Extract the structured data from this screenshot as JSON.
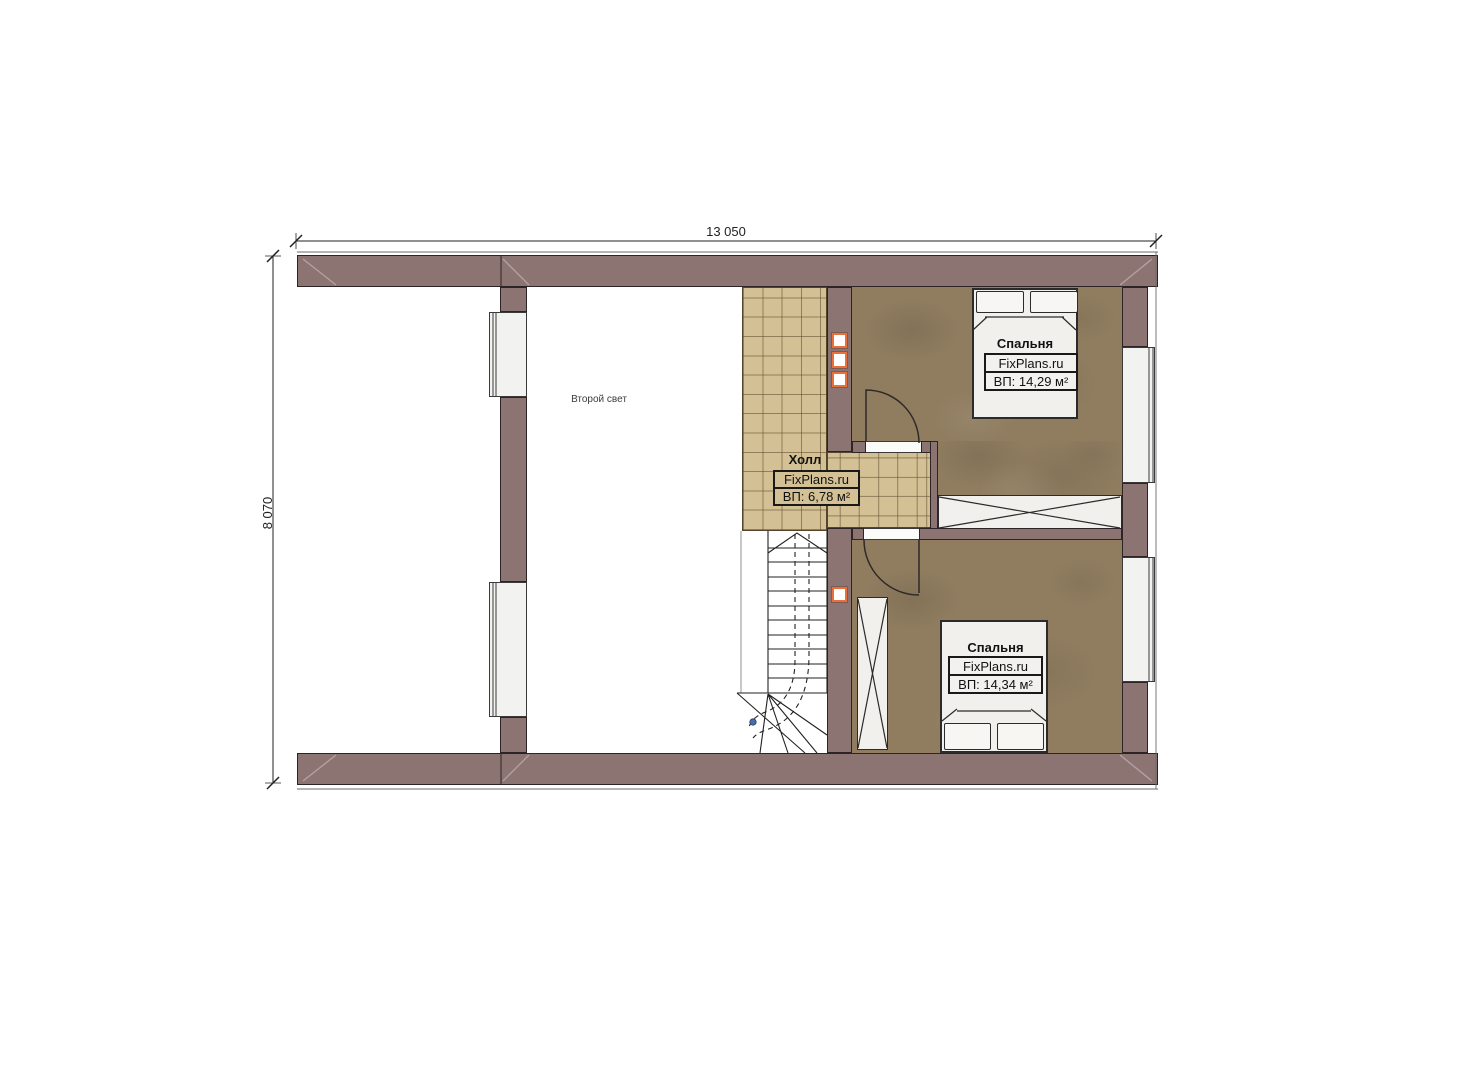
{
  "plan": {
    "title_note": "Второй свет",
    "dimensions": {
      "width_label": "13 050",
      "height_label": "8 070"
    },
    "rooms": {
      "hall": {
        "name": "Холл",
        "brand": "FixPlans.ru",
        "area": "ВП: 6,78 м²"
      },
      "bedroom_top": {
        "name": "Спальня",
        "brand": "FixPlans.ru",
        "area": "ВП: 14,29 м²"
      },
      "bedroom_bottom": {
        "name": "Спальня",
        "brand": "FixPlans.ru",
        "area": "ВП: 14,34 м²"
      }
    },
    "colors": {
      "wall": "#8c7472",
      "tile_floor": "#d3c094",
      "bedroom_floor": "#907d60",
      "marker_accent": "#e8703a"
    }
  }
}
